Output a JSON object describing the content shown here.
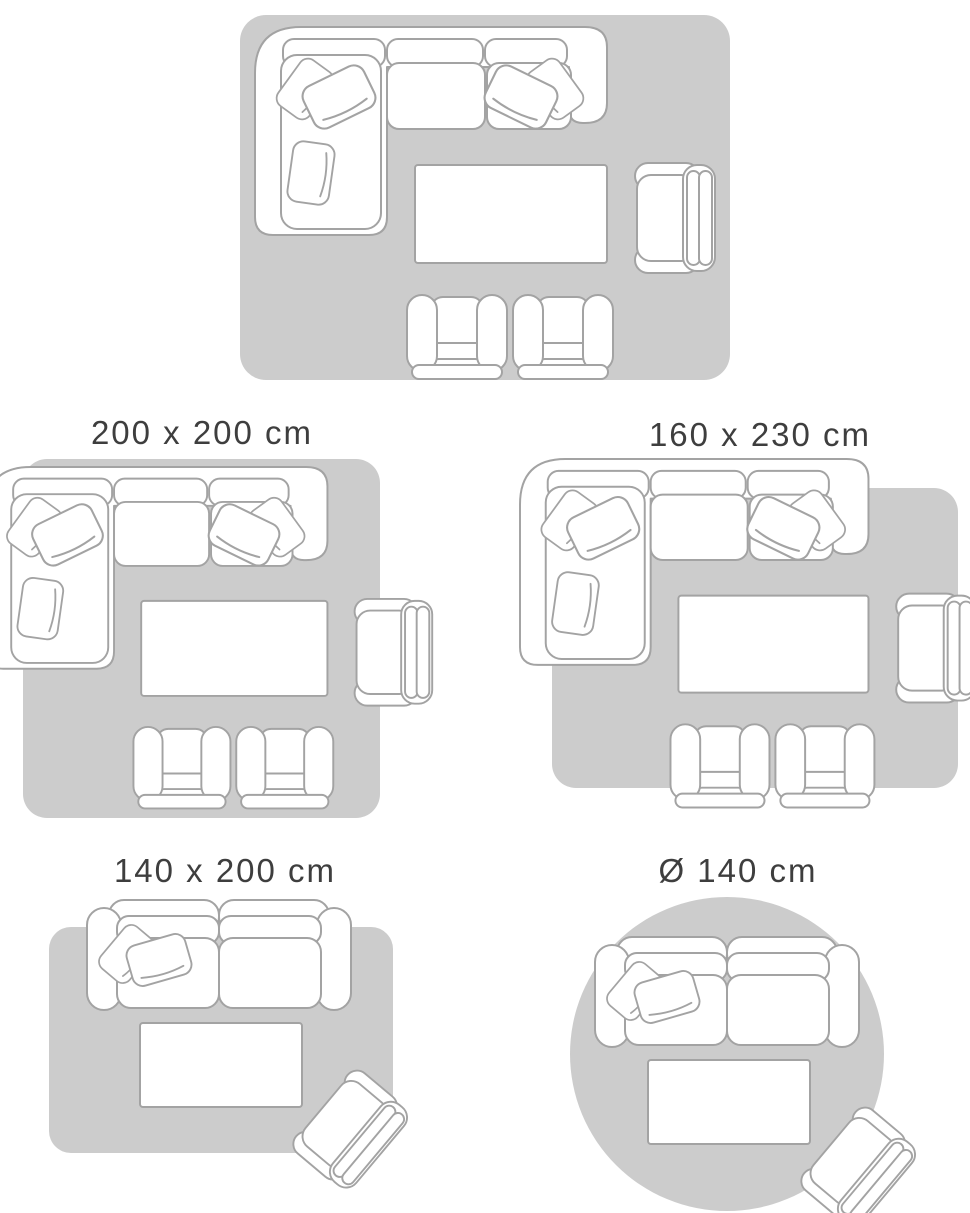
{
  "colors": {
    "background": "#ffffff",
    "rug_fill": "#cccccc",
    "furniture_outline": "#a3a3a3",
    "furniture_fill": "#ffffff",
    "label_text": "#3e3e3e"
  },
  "diagrams": [
    {
      "label": "200 x 300 cm",
      "rug_shape": "rectangle",
      "label_cropped_at_top": true,
      "furniture_icons": [
        "sectional-sofa-icon",
        "pillow-icon",
        "coffee-table-icon",
        "armchair-icon",
        "club-chair-icon",
        "club-chair-icon"
      ]
    },
    {
      "label": "200 x 200 cm",
      "rug_shape": "square",
      "furniture_icons": [
        "sectional-sofa-icon",
        "pillow-icon",
        "coffee-table-icon",
        "armchair-icon",
        "club-chair-icon",
        "club-chair-icon"
      ]
    },
    {
      "label": "160 x 230 cm",
      "rug_shape": "rectangle",
      "furniture_icons": [
        "sectional-sofa-icon",
        "pillow-icon",
        "coffee-table-icon",
        "armchair-icon",
        "club-chair-icon",
        "club-chair-icon"
      ]
    },
    {
      "label": "140 x 200 cm",
      "rug_shape": "rectangle",
      "furniture_icons": [
        "two-seat-sofa-icon",
        "pillow-icon",
        "coffee-table-icon",
        "rotated-armchair-icon"
      ]
    },
    {
      "label": "Ø 140 cm",
      "rug_shape": "circle",
      "furniture_icons": [
        "two-seat-sofa-icon",
        "pillow-icon",
        "coffee-table-icon",
        "rotated-armchair-icon"
      ]
    }
  ]
}
